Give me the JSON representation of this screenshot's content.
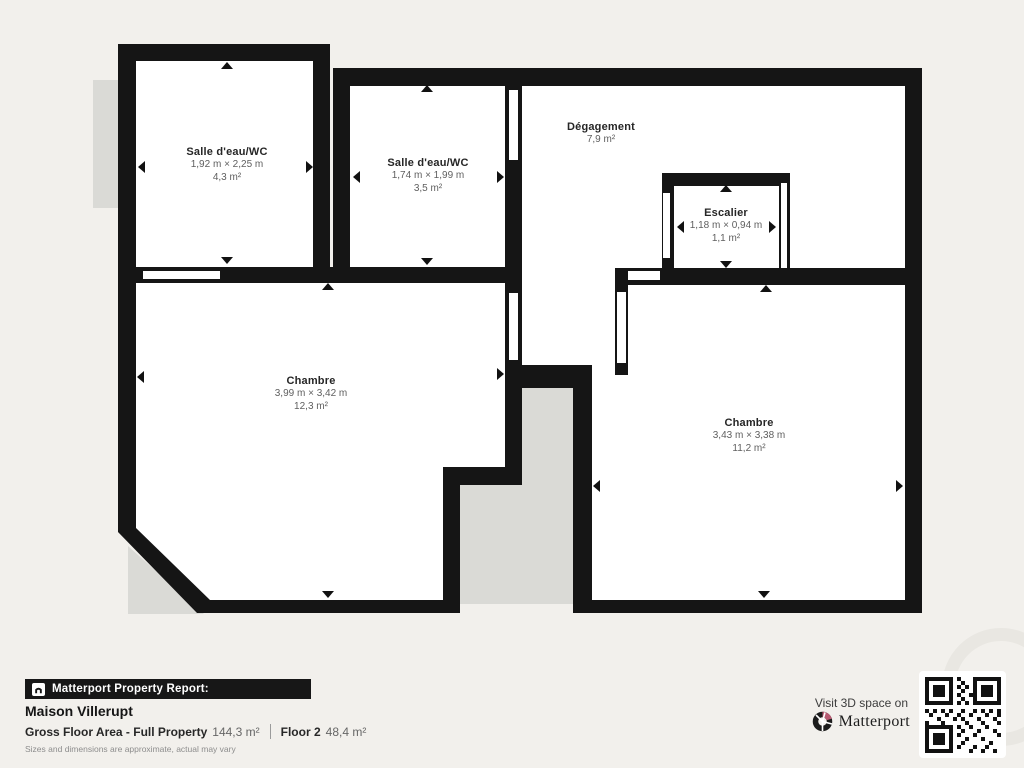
{
  "plan": {
    "rooms": [
      {
        "name": "Salle d'eau/WC",
        "dimensions": "1,92 m × 2,25 m",
        "area": "4,3 m²"
      },
      {
        "name": "Salle d'eau/WC",
        "dimensions": "1,74 m × 1,99 m",
        "area": "3,5 m²"
      },
      {
        "name": "Dégagement",
        "dimensions": "",
        "area": "7,9 m²"
      },
      {
        "name": "Escalier",
        "dimensions": "1,18 m × 0,94 m",
        "area": "1,1 m²"
      },
      {
        "name": "Chambre",
        "dimensions": "3,99 m × 3,42 m",
        "area": "12,3 m²"
      },
      {
        "name": "Chambre",
        "dimensions": "3,43 m × 3,38 m",
        "area": "11,2 m²"
      }
    ]
  },
  "footer": {
    "report_label": "Matterport Property Report:",
    "property_name": "Maison Villerupt",
    "gross_floor_area_label": "Gross Floor Area - Full Property",
    "gross_floor_area_value": "144,3 m²",
    "floor_label": "Floor 2",
    "floor_value": "48,4 m²",
    "disclaimer": "Sizes and dimensions are approximate, actual may vary",
    "visit_label": "Visit 3D space on",
    "brand": "Matterport"
  },
  "colors": {
    "background": "#f2f0ec",
    "walls": "#151515",
    "floor": "#ffffff",
    "void": "#dadad6",
    "brand_accent": "#b85a72",
    "banner_background": "#171717"
  }
}
